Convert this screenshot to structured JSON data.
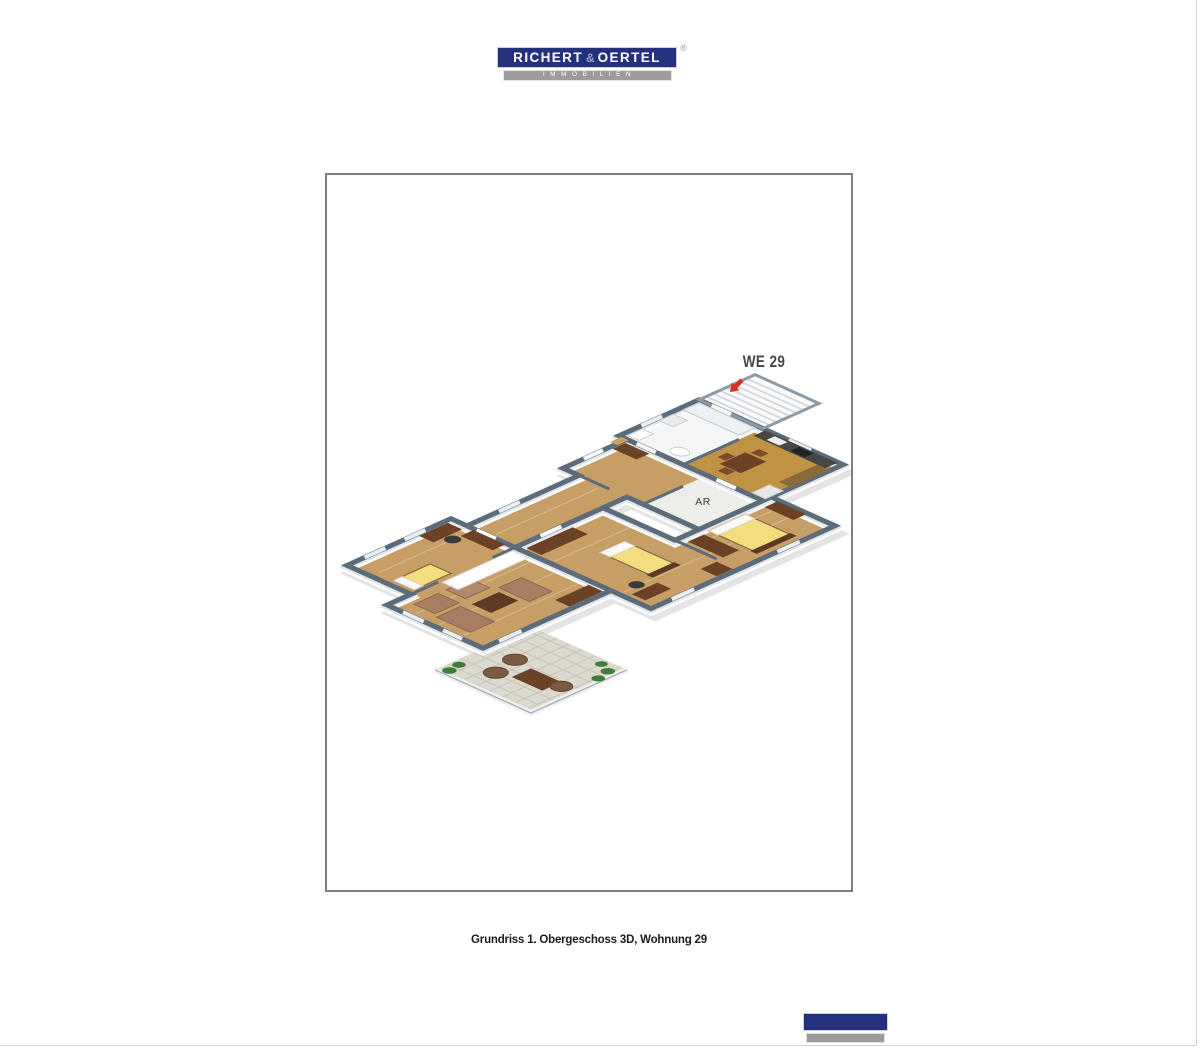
{
  "header_logo": {
    "word1": "RICHERT",
    "amp": "&",
    "word2": "OERTEL",
    "registered_mark": "®",
    "subtitle": "IMMOBILIEN",
    "navy_color": "#26317e",
    "gray_bar_color": "#9c9c9c"
  },
  "floorplan": {
    "unit_label": "WE 29",
    "storage_room_label": "AR",
    "frame_border_color": "#7e7e7e",
    "colors": {
      "wall_cap": "#5d6c7b",
      "wall_side": "#ffffff",
      "wood_floor": "#c79e66",
      "kitchen_floor": "#c09344",
      "bath_floor": "#f4f5f6",
      "stairs_floor": "#fbfbfb",
      "storage_floor": "#ededea",
      "terrace_floor": "#dcd9cf",
      "bed_yellow": "#f3dd7f",
      "sofa_brown": "#a87d62",
      "furniture_dark": "#6b4226",
      "plant_green": "#3e7c39",
      "arrow_red": "#d63127"
    }
  },
  "caption": {
    "text": "Grundriss 1. Obergeschoss 3D, Wohnung 29"
  },
  "footer_logo": {
    "navy_color": "#26317e",
    "gray_bar_color": "#9c9c9c"
  },
  "page": {
    "edge_line_color": "#d4d4d4"
  }
}
